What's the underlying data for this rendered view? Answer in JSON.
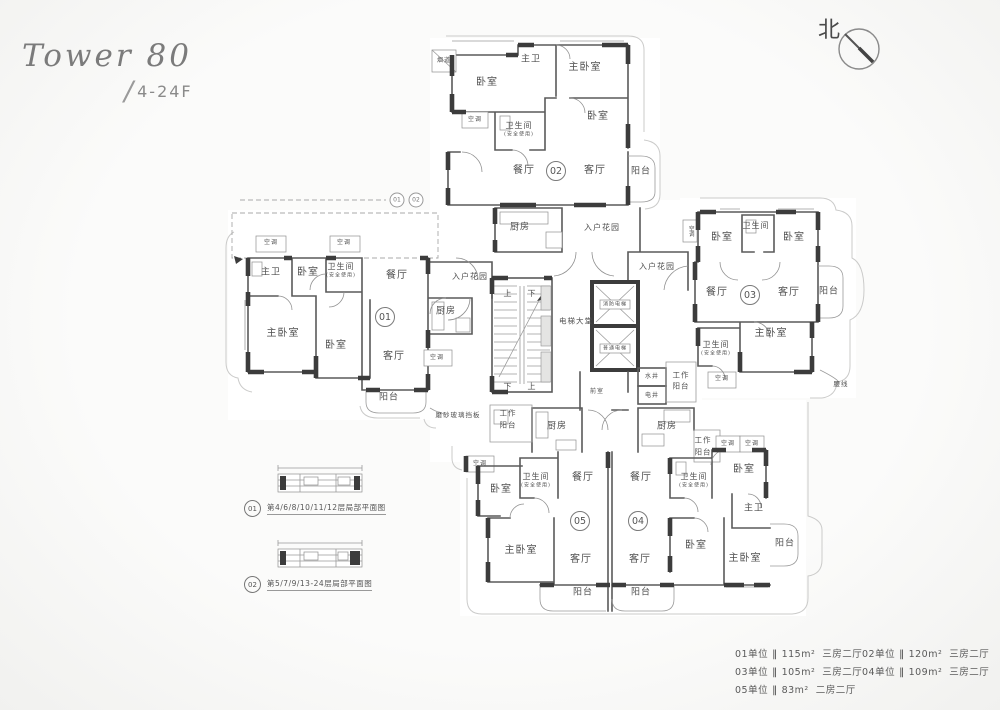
{
  "title": {
    "name": "Tower 80",
    "slash": "/",
    "floors": "4-24F"
  },
  "compass": {
    "label": "北"
  },
  "plan": {
    "unit_circles": [
      {
        "n": "01",
        "x": 385,
        "y": 317
      },
      {
        "n": "02",
        "x": 556,
        "y": 171
      },
      {
        "n": "03",
        "x": 750,
        "y": 295
      },
      {
        "n": "04",
        "x": 638,
        "y": 521
      },
      {
        "n": "05",
        "x": 580,
        "y": 521
      }
    ],
    "ref_circles": [
      {
        "n": "01",
        "x": 397,
        "y": 200
      },
      {
        "n": "02",
        "x": 416,
        "y": 200
      }
    ],
    "labels": [
      {
        "t": "烟道",
        "x": 444,
        "y": 61,
        "s": 6
      },
      {
        "t": "卧室",
        "x": 487,
        "y": 83,
        "s": 10
      },
      {
        "t": "主卫",
        "x": 531,
        "y": 60,
        "s": 9
      },
      {
        "t": "主卧室",
        "x": 585,
        "y": 68,
        "s": 10
      },
      {
        "t": "空调",
        "x": 475,
        "y": 120,
        "s": 6
      },
      {
        "t": "卫生间",
        "x": 519,
        "y": 126,
        "s": 8
      },
      {
        "t": "(安全使用)",
        "x": 519,
        "y": 135,
        "s": 5
      },
      {
        "t": "卧室",
        "x": 598,
        "y": 117,
        "s": 10
      },
      {
        "t": "餐厅",
        "x": 524,
        "y": 171,
        "s": 10
      },
      {
        "t": "客厅",
        "x": 595,
        "y": 171,
        "s": 10
      },
      {
        "t": "阳台",
        "x": 641,
        "y": 172,
        "s": 9
      },
      {
        "t": "空调",
        "x": 271,
        "y": 243,
        "s": 6
      },
      {
        "t": "空调",
        "x": 344,
        "y": 243,
        "s": 6
      },
      {
        "t": "主卫",
        "x": 271,
        "y": 273,
        "s": 9
      },
      {
        "t": "卧室",
        "x": 308,
        "y": 273,
        "s": 10
      },
      {
        "t": "卫生间",
        "x": 341,
        "y": 267,
        "s": 8
      },
      {
        "t": "(安全使用)",
        "x": 341,
        "y": 276,
        "s": 5
      },
      {
        "t": "餐厅",
        "x": 397,
        "y": 276,
        "s": 10
      },
      {
        "t": "入户花园",
        "x": 470,
        "y": 277,
        "s": 8
      },
      {
        "t": "厨房",
        "x": 446,
        "y": 312,
        "s": 9
      },
      {
        "t": "主卧室",
        "x": 283,
        "y": 334,
        "s": 10
      },
      {
        "t": "卧室",
        "x": 336,
        "y": 346,
        "s": 10
      },
      {
        "t": "客厅",
        "x": 394,
        "y": 357,
        "s": 10
      },
      {
        "t": "空调",
        "x": 437,
        "y": 358,
        "s": 6
      },
      {
        "t": "阳台",
        "x": 389,
        "y": 398,
        "s": 9
      },
      {
        "t": "磨砂玻璃挡板",
        "x": 458,
        "y": 415,
        "s": 6.5
      },
      {
        "t": "空调",
        "x": 690,
        "y": 231,
        "s": 5.5,
        "v": 1
      },
      {
        "t": "卧室",
        "x": 722,
        "y": 238,
        "s": 10
      },
      {
        "t": "卫生间",
        "x": 756,
        "y": 226,
        "s": 8
      },
      {
        "t": "卧室",
        "x": 794,
        "y": 238,
        "s": 10
      },
      {
        "t": "餐厅",
        "x": 717,
        "y": 293,
        "s": 10
      },
      {
        "t": "客厅",
        "x": 789,
        "y": 293,
        "s": 10
      },
      {
        "t": "阳台",
        "x": 829,
        "y": 292,
        "s": 9
      },
      {
        "t": "卫生间",
        "x": 716,
        "y": 345,
        "s": 8
      },
      {
        "t": "(安全使用)",
        "x": 716,
        "y": 354,
        "s": 5
      },
      {
        "t": "主卧室",
        "x": 771,
        "y": 334,
        "s": 10
      },
      {
        "t": "空调",
        "x": 722,
        "y": 379,
        "s": 6
      },
      {
        "t": "腰线",
        "x": 841,
        "y": 384,
        "s": 6.5
      },
      {
        "t": "厨房",
        "x": 520,
        "y": 228,
        "s": 9
      },
      {
        "t": "入户花园",
        "x": 602,
        "y": 228,
        "s": 8
      },
      {
        "t": "入户花园",
        "x": 657,
        "y": 267,
        "s": 8
      },
      {
        "t": "上",
        "x": 508,
        "y": 294,
        "s": 8
      },
      {
        "t": "下",
        "x": 532,
        "y": 294,
        "s": 8
      },
      {
        "t": "电梯大堂",
        "x": 576,
        "y": 321,
        "s": 7.5
      },
      {
        "t": "消防电梯",
        "x": 615,
        "y": 305,
        "s": 5
      },
      {
        "t": "普通电梯",
        "x": 615,
        "y": 349,
        "s": 5
      },
      {
        "t": "下",
        "x": 508,
        "y": 387,
        "s": 8
      },
      {
        "t": "上",
        "x": 532,
        "y": 387,
        "s": 8
      },
      {
        "t": "前室",
        "x": 597,
        "y": 392,
        "s": 6
      },
      {
        "t": "水井",
        "x": 652,
        "y": 377,
        "s": 6
      },
      {
        "t": "电井",
        "x": 652,
        "y": 396,
        "s": 6
      },
      {
        "t": "工作",
        "x": 681,
        "y": 375,
        "s": 7.5
      },
      {
        "t": "阳台",
        "x": 681,
        "y": 386,
        "s": 7.5
      },
      {
        "t": "工作",
        "x": 508,
        "y": 413,
        "s": 7.5
      },
      {
        "t": "阳台",
        "x": 508,
        "y": 425,
        "s": 7.5
      },
      {
        "t": "厨房",
        "x": 557,
        "y": 427,
        "s": 9
      },
      {
        "t": "厨房",
        "x": 667,
        "y": 427,
        "s": 9
      },
      {
        "t": "工作",
        "x": 703,
        "y": 440,
        "s": 7.5
      },
      {
        "t": "阳台",
        "x": 703,
        "y": 452,
        "s": 7.5
      },
      {
        "t": "空调",
        "x": 480,
        "y": 464,
        "s": 6
      },
      {
        "t": "卫生间",
        "x": 536,
        "y": 477,
        "s": 8
      },
      {
        "t": "(安全使用)",
        "x": 536,
        "y": 486,
        "s": 5
      },
      {
        "t": "卧室",
        "x": 501,
        "y": 490,
        "s": 10
      },
      {
        "t": "餐厅",
        "x": 583,
        "y": 478,
        "s": 10
      },
      {
        "t": "主卧室",
        "x": 521,
        "y": 551,
        "s": 10
      },
      {
        "t": "客厅",
        "x": 581,
        "y": 560,
        "s": 10
      },
      {
        "t": "阳台",
        "x": 583,
        "y": 593,
        "s": 9
      },
      {
        "t": "餐厅",
        "x": 641,
        "y": 478,
        "s": 10
      },
      {
        "t": "客厅",
        "x": 640,
        "y": 560,
        "s": 10
      },
      {
        "t": "阳台",
        "x": 641,
        "y": 593,
        "s": 9
      },
      {
        "t": "卫生间",
        "x": 694,
        "y": 477,
        "s": 8
      },
      {
        "t": "(安全使用)",
        "x": 694,
        "y": 486,
        "s": 5
      },
      {
        "t": "卧室",
        "x": 744,
        "y": 470,
        "s": 10
      },
      {
        "t": "空调",
        "x": 728,
        "y": 444,
        "s": 6
      },
      {
        "t": "空调",
        "x": 752,
        "y": 444,
        "s": 6
      },
      {
        "t": "主卫",
        "x": 754,
        "y": 509,
        "s": 9
      },
      {
        "t": "卧室",
        "x": 696,
        "y": 546,
        "s": 10
      },
      {
        "t": "主卧室",
        "x": 745,
        "y": 559,
        "s": 10
      },
      {
        "t": "阳台",
        "x": 785,
        "y": 544,
        "s": 9
      }
    ]
  },
  "details": {
    "items": [
      {
        "n": "01",
        "text": "第4/6/8/10/11/12层局部平面图"
      },
      {
        "n": "02",
        "text": "第5/7/9/13-24层局部平面图"
      }
    ]
  },
  "legend": {
    "sep": "‖",
    "items": [
      {
        "unit": "01单位",
        "area": "115m²",
        "type": "三房二厅"
      },
      {
        "unit": "02单位",
        "area": "120m²",
        "type": "三房二厅"
      },
      {
        "unit": "03单位",
        "area": "105m²",
        "type": "三房二厅"
      },
      {
        "unit": "04单位",
        "area": "109m²",
        "type": "三房二厅"
      },
      {
        "unit": "05单位",
        "area": "83m²",
        "type": "二房二厅"
      }
    ]
  },
  "colors": {
    "wall": "#3c3c3c",
    "line": "#5a5a5a",
    "text": "#4f4f4f",
    "envelope": "#cbcbca"
  }
}
